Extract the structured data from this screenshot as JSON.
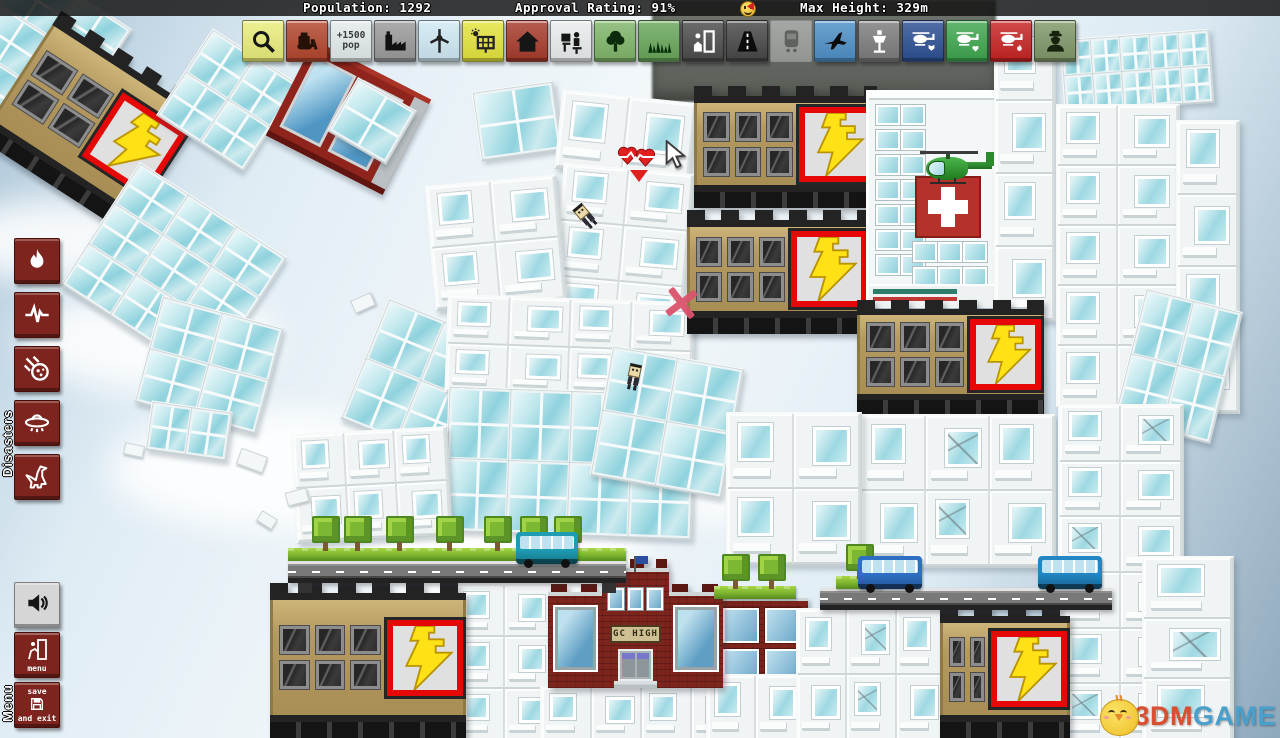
{
  "hud": {
    "top_bar": {
      "population_label": "Population:",
      "population_value": "1292",
      "approval_label": "Approval Rating:",
      "approval_value": "91%",
      "smiley_icon": "happy-face",
      "max_height_label": "Max Height:",
      "max_height_value": "329m"
    },
    "toolbar": [
      {
        "name": "zoom-tool-button",
        "icon": "magnifier",
        "color": "#e9ed7a"
      },
      {
        "name": "bulldozer-tool-button",
        "icon": "bulldozer",
        "color": "#b2452c"
      },
      {
        "name": "population-block-button",
        "icon": "pop-label",
        "color": "#e3ebec",
        "label_top": "+1500",
        "label_bottom": "pop"
      },
      {
        "name": "factory-button",
        "icon": "factory",
        "color": "#9a9a9a"
      },
      {
        "name": "wind-turbine-button",
        "icon": "turbine",
        "color": "#cfe9f4"
      },
      {
        "name": "solar-panel-button",
        "icon": "solar",
        "color": "#e4e43c"
      },
      {
        "name": "house-button",
        "icon": "house",
        "color": "#a63a2b"
      },
      {
        "name": "office-button",
        "icon": "office",
        "color": "#e9edee"
      },
      {
        "name": "tree-button",
        "icon": "tree",
        "color": "#7fb569"
      },
      {
        "name": "grass-button",
        "icon": "grass",
        "color": "#68a659"
      },
      {
        "name": "jail-button",
        "icon": "door-person",
        "color": "#4b4b4b"
      },
      {
        "name": "road-button",
        "icon": "road",
        "color": "#474747"
      },
      {
        "name": "train-button",
        "icon": "train",
        "color": "#c9cdcd",
        "disabled": true
      },
      {
        "name": "airplane-button",
        "icon": "plane",
        "color": "#4d8fc6"
      },
      {
        "name": "airport-tower-button",
        "icon": "control-tower",
        "color": "#7c7c7c"
      },
      {
        "name": "police-helicopter-button",
        "icon": "heli-badge",
        "color": "#2c4f92"
      },
      {
        "name": "medic-helicopter-button",
        "icon": "heli-heart",
        "color": "#3ea64e"
      },
      {
        "name": "fire-helicopter-button",
        "icon": "heli-flame",
        "color": "#c72322"
      },
      {
        "name": "police-officer-button",
        "icon": "officer",
        "color": "#7f9768"
      }
    ],
    "disasters": {
      "label": "Disasters",
      "buttons": [
        {
          "name": "fire-disaster-button",
          "icon": "flame"
        },
        {
          "name": "earthquake-disaster-button",
          "icon": "seismo"
        },
        {
          "name": "meteor-disaster-button",
          "icon": "meteor"
        },
        {
          "name": "ufo-disaster-button",
          "icon": "ufo"
        },
        {
          "name": "dinosaur-disaster-button",
          "icon": "dino"
        }
      ]
    },
    "menu": {
      "label": "Menu",
      "sound_button_icon": "speaker",
      "menu_button_label": "menu",
      "save_button_line1": "save",
      "save_button_line2": "and exit"
    }
  },
  "watermark": {
    "text_3dm": "3DM",
    "text_game": "GAME"
  },
  "signs": {
    "school": "GC HIGH"
  },
  "scene": {
    "clouds": [
      {
        "x": 20,
        "y": 290,
        "w": 260,
        "h": 100
      },
      {
        "x": 110,
        "y": 410,
        "w": 330,
        "h": 120
      },
      {
        "x": -50,
        "y": 200,
        "w": 200,
        "h": 80
      },
      {
        "x": 360,
        "y": 500,
        "w": 280,
        "h": 110
      },
      {
        "x": 620,
        "y": 430,
        "w": 200,
        "h": 90
      }
    ],
    "buildings": [
      {
        "t": "stone",
        "n": "background-building",
        "x": 652,
        "y": 0,
        "w": 344,
        "h": 102
      },
      {
        "t": "glass",
        "v": "wall",
        "n": "tilted-glass-tower",
        "x": -28,
        "y": -18,
        "w": 125,
        "h": 150,
        "rot": 33,
        "c": 2,
        "r": 3
      },
      {
        "t": "power",
        "n": "power-plant-tilted",
        "x": 6,
        "y": 46,
        "w": 175,
        "h": 152,
        "rot": 33,
        "wc": 2
      },
      {
        "t": "glass",
        "v": "wall",
        "n": "glass-slab",
        "x": 176,
        "y": 48,
        "w": 100,
        "h": 100,
        "rot": 33,
        "c": 2,
        "r": 2
      },
      {
        "t": "redfrag",
        "n": "red-apartment-fragment",
        "x": 283,
        "y": 64,
        "w": 115,
        "h": 80,
        "rot": 27
      },
      {
        "t": "glass",
        "v": "wall",
        "n": "glass-chunk",
        "x": 338,
        "y": 90,
        "w": 64,
        "h": 58,
        "rot": 30,
        "c": 1,
        "r": 1
      },
      {
        "t": "glass",
        "v": "wall",
        "n": "glass-chunk",
        "x": 476,
        "y": 86,
        "w": 78,
        "h": 66,
        "rot": -8,
        "c": 1,
        "r": 1
      },
      {
        "t": "glass",
        "v": "wall",
        "n": "tilted-glass-slab",
        "x": 86,
        "y": 198,
        "w": 172,
        "h": 142,
        "rot": 33,
        "c": 3,
        "r": 3
      },
      {
        "t": "glass",
        "v": "wall",
        "n": "tilted-glass-slab",
        "x": 146,
        "y": 310,
        "w": 122,
        "h": 106,
        "rot": 15,
        "c": 2,
        "r": 2
      },
      {
        "t": "glass",
        "v": "wall",
        "n": "glass-chunk",
        "x": 148,
        "y": 406,
        "w": 78,
        "h": 46,
        "rot": 8,
        "c": 2,
        "r": 1
      },
      {
        "t": "glass",
        "v": "apt",
        "n": "apartment-tower",
        "x": 558,
        "y": 96,
        "w": 132,
        "h": 76,
        "rot": 6,
        "c": 2,
        "r": 1
      },
      {
        "t": "glass",
        "v": "apt",
        "n": "apartment-tower",
        "x": 556,
        "y": 168,
        "w": 128,
        "h": 168,
        "rot": 5,
        "c": 2,
        "r": 3
      },
      {
        "t": "glass",
        "v": "apt",
        "n": "apartment-tower",
        "x": 430,
        "y": 180,
        "w": 128,
        "h": 122,
        "rot": -5,
        "c": 2,
        "r": 2
      },
      {
        "t": "glass",
        "v": "wall",
        "n": "tilted-glass-slab",
        "x": 360,
        "y": 316,
        "w": 118,
        "h": 126,
        "rot": 22,
        "c": 2,
        "r": 2
      },
      {
        "t": "glass",
        "v": "apt",
        "n": "apartment-block",
        "x": 446,
        "y": 298,
        "w": 244,
        "h": 96,
        "rot": 2,
        "c": 4,
        "r": 2
      },
      {
        "t": "glass",
        "v": "wall",
        "n": "glass-curtain-block",
        "x": 446,
        "y": 390,
        "w": 244,
        "h": 142,
        "rot": 2,
        "c": 4,
        "r": 2
      },
      {
        "t": "glass",
        "v": "wall",
        "n": "tilted-glass-block",
        "x": 600,
        "y": 356,
        "w": 130,
        "h": 128,
        "rot": 10,
        "c": 2,
        "r": 2
      },
      {
        "t": "glass",
        "v": "apt",
        "n": "apartment-block",
        "x": 294,
        "y": 430,
        "w": 152,
        "h": 106,
        "rot": -3,
        "c": 3,
        "r": 2
      },
      {
        "t": "glass",
        "v": "apt",
        "n": "apartment-tower",
        "x": 455,
        "y": 584,
        "w": 96,
        "h": 154,
        "c": 2,
        "r": 3
      },
      {
        "t": "glass",
        "v": "apt",
        "n": "apartment-block",
        "x": 540,
        "y": 686,
        "w": 200,
        "h": 52,
        "c": 4,
        "r": 1
      },
      {
        "t": "power",
        "n": "power-plant",
        "x": 694,
        "y": 86,
        "w": 183,
        "h": 122
      },
      {
        "t": "power",
        "n": "power-plant",
        "x": 687,
        "y": 210,
        "w": 183,
        "h": 124
      },
      {
        "t": "hospital",
        "n": "hospital",
        "x": 866,
        "y": 90,
        "w": 126,
        "h": 218
      },
      {
        "t": "glass",
        "v": "apt",
        "n": "apartment-tower",
        "x": 994,
        "y": 26,
        "w": 58,
        "h": 292,
        "c": 1,
        "r": 4
      },
      {
        "t": "power",
        "n": "power-plant",
        "x": 857,
        "y": 300,
        "w": 187,
        "h": 114
      },
      {
        "t": "glass",
        "v": "apt",
        "n": "apartment-block",
        "x": 860,
        "y": 414,
        "w": 192,
        "h": 150,
        "c": 3,
        "r": 2,
        "cracks": true
      },
      {
        "t": "glass",
        "v": "apt",
        "n": "apartment-block",
        "x": 726,
        "y": 412,
        "w": 132,
        "h": 150,
        "c": 2,
        "r": 2
      },
      {
        "t": "glass",
        "v": "wall",
        "n": "glass-slab",
        "x": 1062,
        "y": 34,
        "w": 146,
        "h": 70,
        "rot": -4,
        "c": 5,
        "r": 2
      },
      {
        "t": "glass",
        "v": "apt",
        "n": "apartment-tower",
        "x": 1056,
        "y": 104,
        "w": 120,
        "h": 300,
        "c": 2,
        "r": 5
      },
      {
        "t": "glass",
        "v": "apt",
        "n": "apartment-tower",
        "x": 1176,
        "y": 120,
        "w": 60,
        "h": 290,
        "c": 1,
        "r": 4
      },
      {
        "t": "glass",
        "v": "wall",
        "n": "tilted-glass-slab",
        "x": 1128,
        "y": 298,
        "w": 96,
        "h": 132,
        "rot": 14,
        "c": 2,
        "r": 2
      },
      {
        "t": "glass",
        "v": "apt",
        "n": "apartment-tower",
        "x": 1058,
        "y": 404,
        "w": 122,
        "h": 334,
        "c": 2,
        "r": 6,
        "cracks": true
      },
      {
        "t": "glass",
        "v": "apt",
        "n": "apartment-tower",
        "x": 1142,
        "y": 556,
        "w": 88,
        "h": 182,
        "c": 1,
        "r": 3,
        "cracks": true
      },
      {
        "t": "brick2",
        "n": "maroon-apartment",
        "x": 716,
        "y": 598,
        "w": 78,
        "h": 76
      },
      {
        "t": "glass",
        "v": "apt",
        "n": "apartment-block",
        "x": 706,
        "y": 674,
        "w": 96,
        "h": 64,
        "c": 2,
        "r": 1
      },
      {
        "t": "glass",
        "v": "apt",
        "n": "apartment-block",
        "x": 796,
        "y": 608,
        "w": 148,
        "h": 130,
        "c": 3,
        "r": 2,
        "cracks": true
      },
      {
        "t": "power",
        "n": "power-plant",
        "x": 940,
        "y": 606,
        "w": 130,
        "h": 132,
        "wc": 2
      },
      {
        "t": "power",
        "n": "power-plant",
        "x": 270,
        "y": 583,
        "w": 196,
        "h": 155
      },
      {
        "t": "school",
        "n": "high-school",
        "x": 548,
        "y": 568,
        "w": 175,
        "h": 120
      }
    ],
    "roads": [
      {
        "x": 820,
        "y": 588,
        "w": 292
      }
    ],
    "parks": [
      {
        "n": "tree-park-platform",
        "x": 288,
        "y": 548,
        "w": 338,
        "road": true,
        "trees": [
          24,
          56,
          98,
          148,
          196,
          232,
          266
        ]
      },
      {
        "n": "small-tree-platform",
        "x": 714,
        "y": 586,
        "w": 82,
        "road": false,
        "trees": [
          8,
          44
        ]
      },
      {
        "n": "single-tree-platform",
        "x": 836,
        "y": 576,
        "w": 46,
        "road": false,
        "trees": [
          10
        ]
      }
    ],
    "vehicles": [
      {
        "t": "bus",
        "n": "teal-bus",
        "x": 516,
        "y": 532,
        "w": 62,
        "h": 32,
        "color": "#1d9cb4"
      },
      {
        "t": "bus",
        "n": "blue-bus",
        "x": 858,
        "y": 556,
        "w": 64,
        "h": 33,
        "color": "#2e6fc4"
      },
      {
        "t": "bus",
        "n": "blue-bus",
        "x": 1038,
        "y": 556,
        "w": 64,
        "h": 33,
        "color": "#2286c2"
      },
      {
        "t": "heli",
        "n": "medical-helicopter",
        "x": 920,
        "y": 148,
        "w": 76,
        "h": 42
      }
    ],
    "people": [
      {
        "n": "falling-citizen",
        "x": 576,
        "y": 204,
        "rot": -40
      },
      {
        "n": "falling-citizen",
        "x": 626,
        "y": 364,
        "rot": 12
      }
    ],
    "markers": {
      "hearts": {
        "n": "health-hearts-indicator",
        "x": 616,
        "y": 144
      },
      "cursor": {
        "n": "mouse-cursor",
        "x": 662,
        "y": 140
      },
      "xmark": {
        "n": "red-x-marker",
        "x": 664,
        "y": 286
      }
    },
    "debris": [
      {
        "x": 238,
        "y": 452,
        "w": 26,
        "h": 15,
        "rot": 20
      },
      {
        "x": 286,
        "y": 490,
        "w": 20,
        "h": 12,
        "rot": -14
      },
      {
        "x": 258,
        "y": 514,
        "w": 16,
        "h": 10,
        "rot": 32
      },
      {
        "x": 124,
        "y": 444,
        "w": 18,
        "h": 10,
        "rot": 12
      },
      {
        "x": 352,
        "y": 296,
        "w": 20,
        "h": 12,
        "rot": -24
      }
    ]
  }
}
